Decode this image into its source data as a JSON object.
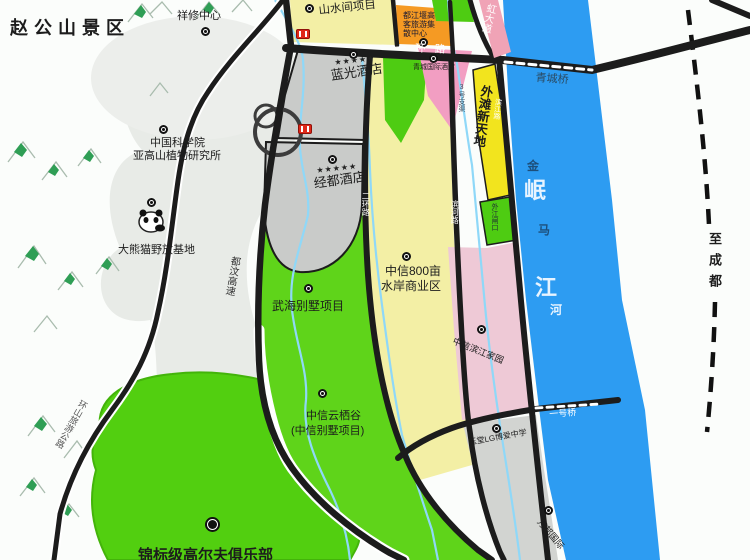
{
  "title": "赵公山景区",
  "colors": {
    "river_blue": "#2d9cf2",
    "district_green": "#5fd41a",
    "golf_green": "#52cf10",
    "parcel_yellow_pale": "#f3efa5",
    "strip_yellow_bright": "#f2e41e",
    "orange_block": "#f59a23",
    "pink_parcel": "#eec9d6",
    "pink_triangle": "#f29ec2",
    "rainbow_ave_pink": "#f0a3b6",
    "gray_parcel": "#c9cbc9",
    "road_black": "#1c1c1c",
    "terrain_gray": "#e8ebe7",
    "mountain_green": "#2f9e55",
    "stream_blue": "#8fd8f8"
  },
  "labels": {
    "region_title": "赵公山景区",
    "xiangxiu": "祥修中心",
    "cas_line1": "中国科学院",
    "cas_line2": "亚高山植物研究所",
    "panda_base": "大熊猫野放基地",
    "duwen_expressway": "都汶高速",
    "huanshan_road": "环山旅游公路",
    "shanshuijian": "山水间项目",
    "tourism_center_l1": "都江堰高",
    "tourism_center_l2": "客旅游集",
    "tourism_center_l3": "散中心",
    "stars": "★★★★★",
    "blueray_hotel": "蓝光酒店",
    "jingdu_hotel": "经都酒店",
    "yihuan_road": "一环路",
    "rainbow_avenue": "虹大道",
    "qingcheng_bridge": "青城桥",
    "canal_no3": "3号支渠",
    "waitan_xintiandi": "外滩新天地",
    "binjiang_road": "滨江路",
    "qingcheng_hotel": "青城国际酒店",
    "waijiang_gate": "外江闸口",
    "erhuan_road": "二环路",
    "binhe_road": "滨河路",
    "citic800_l1": "中信800亩",
    "citic800_l2": "水岸商业区",
    "wuhai_villa": "武海别墅项目",
    "citic_valley_l1": "中信云栖谷",
    "citic_valley_l2": "(中信别墅项目)",
    "golf_club": "锦标级高尔夫俱乐部",
    "citic_binjiang_home": "中信滨江家园",
    "yutang_school": "玉堂LG博爱中学",
    "wanbang": "万邦国际",
    "bridge_no1": "一号桥",
    "to_chengdu": "至成都"
  },
  "river": {
    "chars": [
      "金",
      "岷",
      "马",
      "江",
      "河"
    ]
  }
}
